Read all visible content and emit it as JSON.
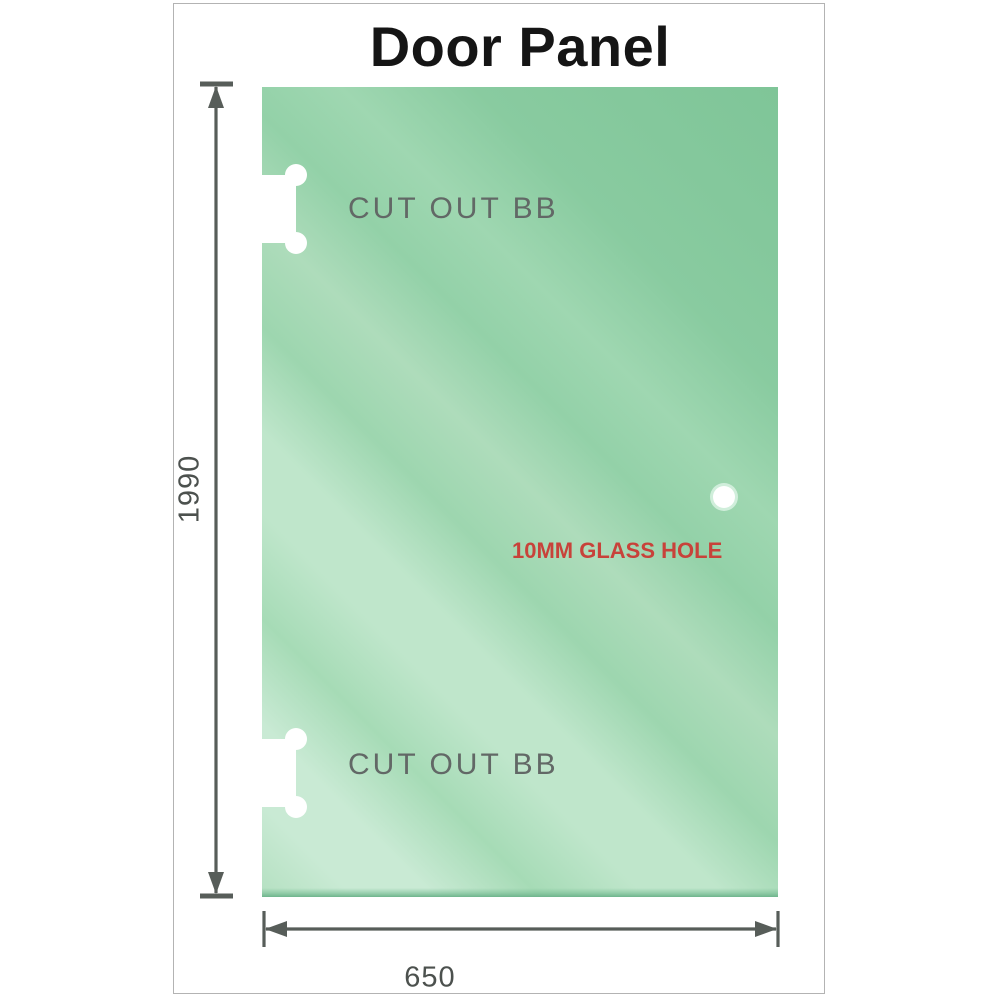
{
  "title": "Door Panel",
  "panel": {
    "cutouts": {
      "top_label": "CUT OUT BB",
      "bottom_label": "CUT OUT BB"
    },
    "glass_hole": {
      "label": "10MM GLASS HOLE"
    }
  },
  "dimensions": {
    "height_mm": "1990",
    "width_mm": "650"
  },
  "colors": {
    "glass_green_mid": "#a6dbb6",
    "glass_green_light": "#c9ead4",
    "glass_green_dark": "#7fc598",
    "glass_edge_dark": "#6fb58d",
    "dimension_gray": "#575d59",
    "cutout_label_gray": "#626866",
    "hole_label_red": "#c8423a",
    "title_black": "#151515",
    "frame_border_gray": "#b3b3b3"
  }
}
